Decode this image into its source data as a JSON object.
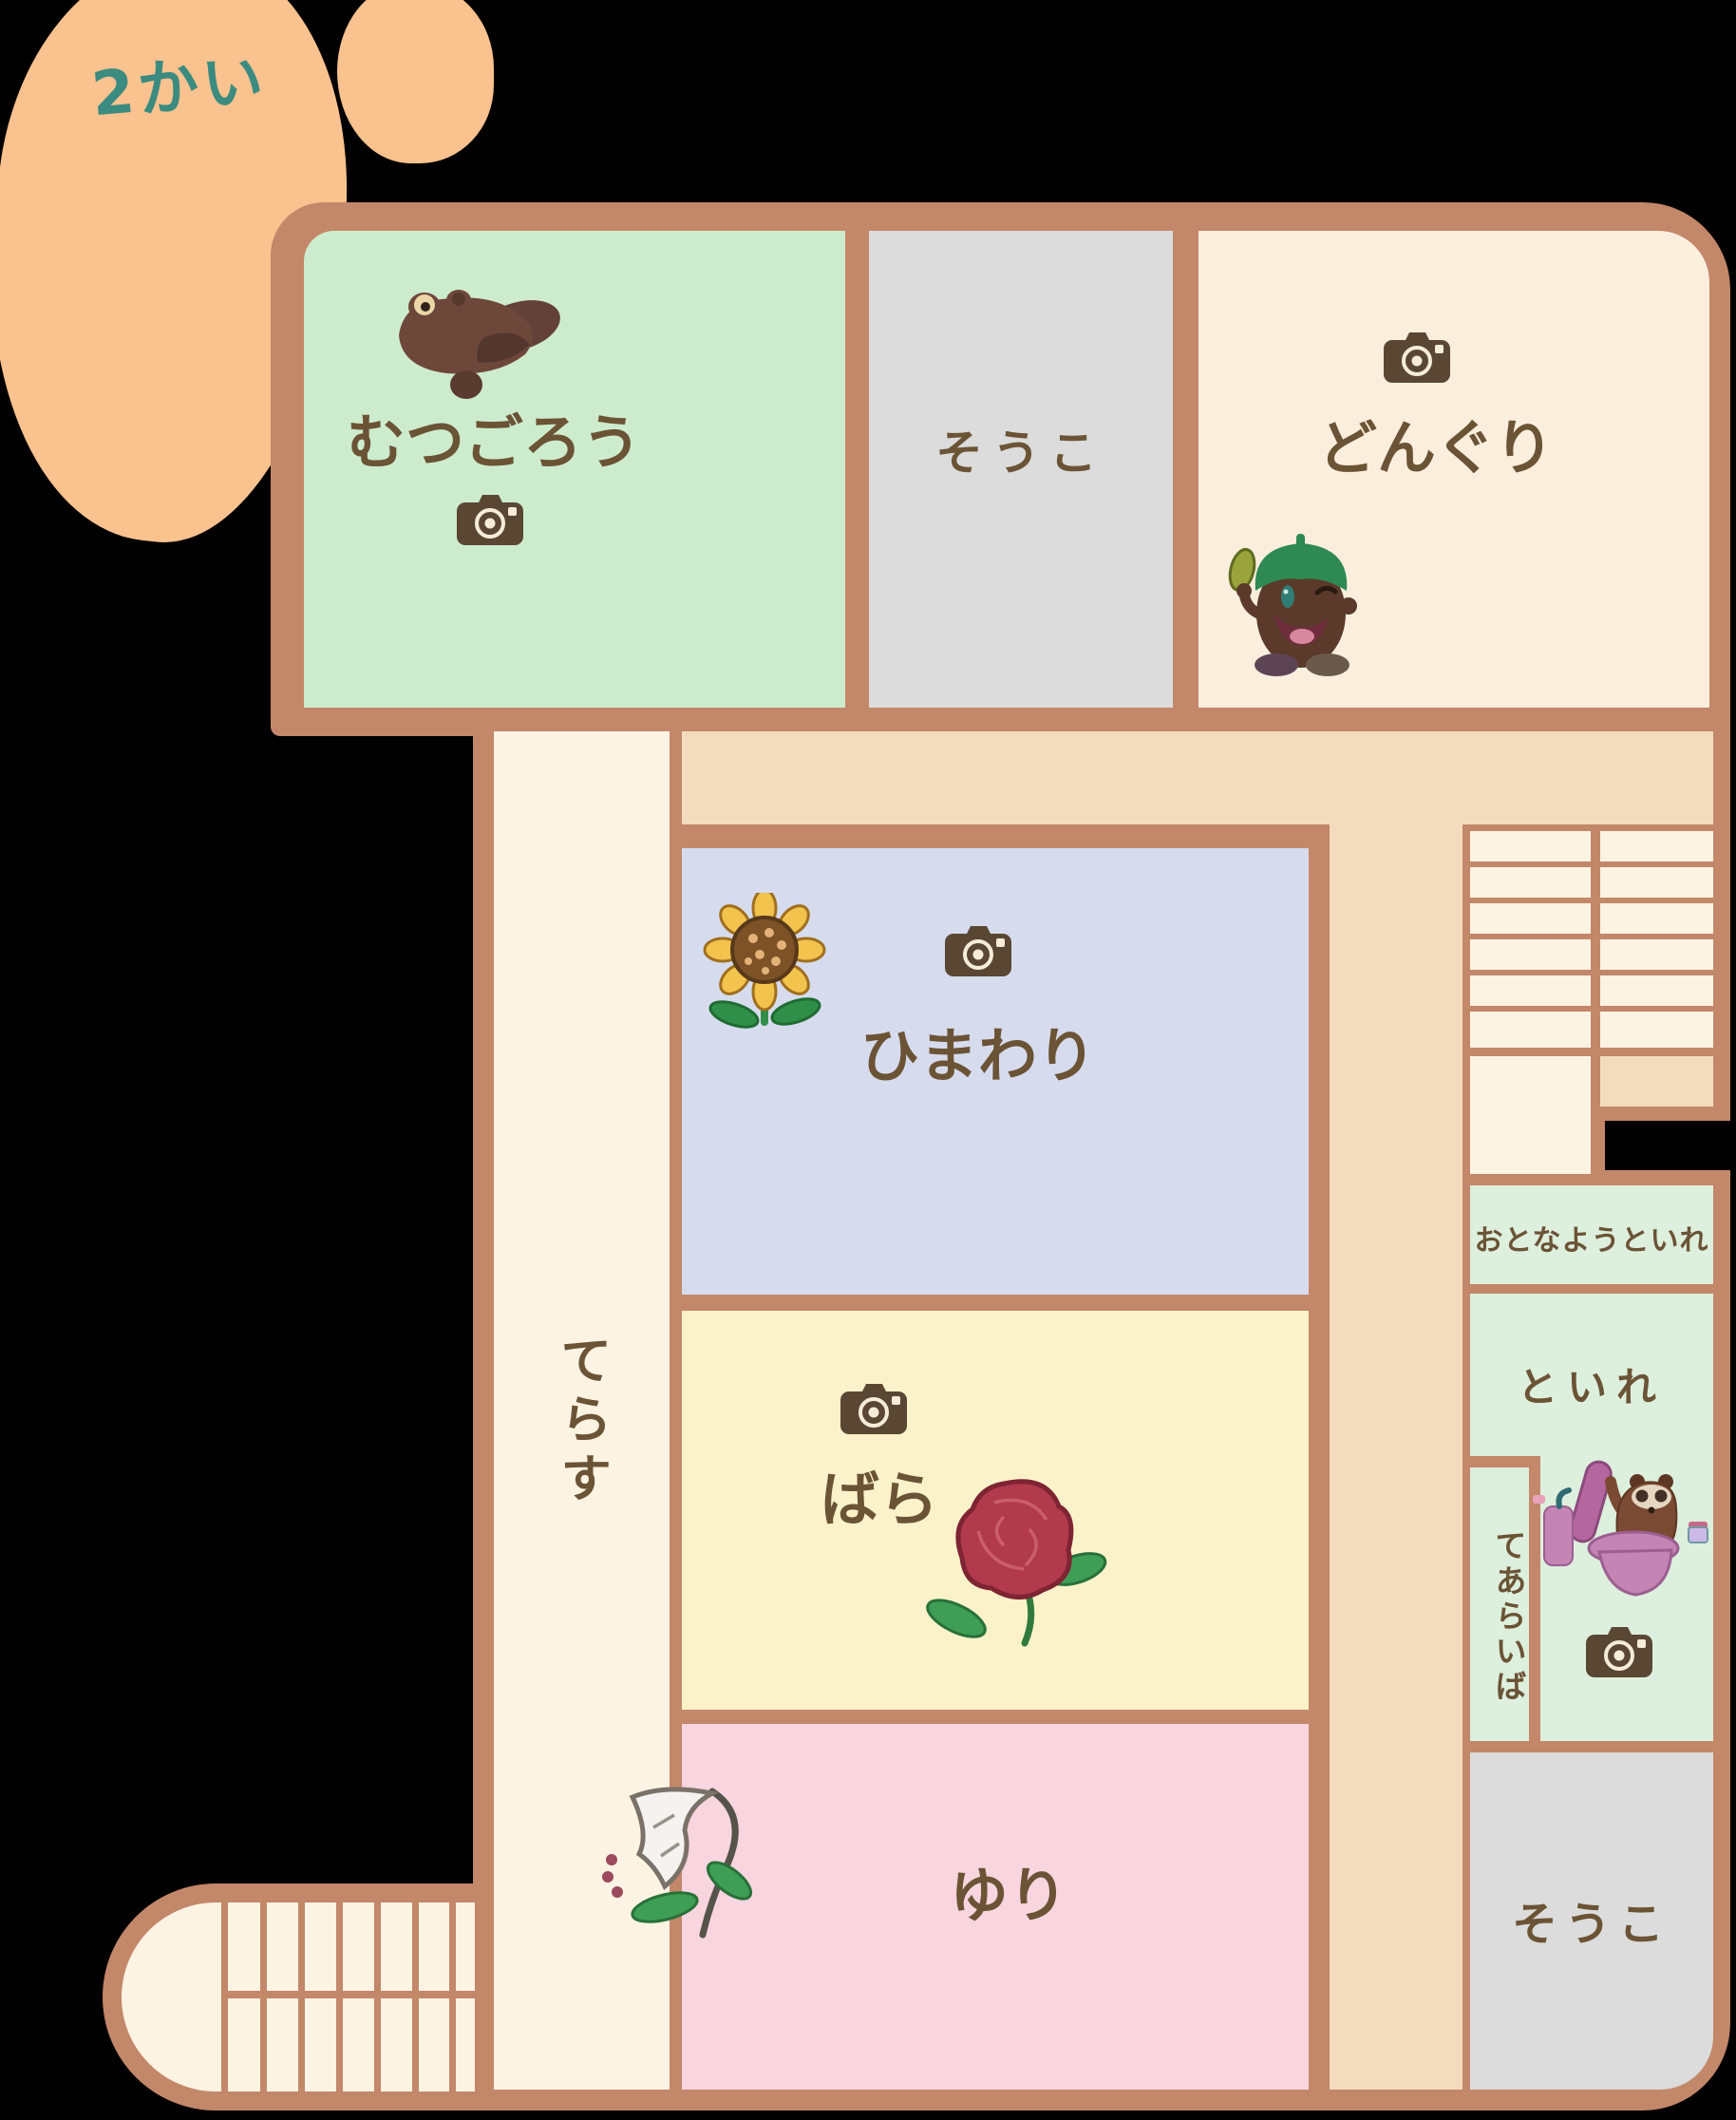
{
  "floor_label": "2かい",
  "building": {
    "rooms": {
      "mutsugorou": {
        "label": "むつごろう"
      },
      "souko_top": {
        "label": "そうこ"
      },
      "donguri": {
        "label": "どんぐり"
      },
      "himawari": {
        "label": "ひまわり"
      },
      "bara": {
        "label": "ばら"
      },
      "yuri": {
        "label": "ゆり"
      },
      "terasu": {
        "label": "てらす"
      },
      "otona_you_toire": {
        "label": "おとなようといれ"
      },
      "toire": {
        "label": "といれ"
      },
      "tearaiba": {
        "label": "てあらいば"
      },
      "souko_bottom": {
        "label": "そうこ"
      }
    },
    "icons": {
      "camera": "camera-icon",
      "mudskipper": "mudskipper-character",
      "acorn": "acorn-character",
      "sunflower": "sunflower-illustration",
      "rose": "rose-illustration",
      "lily": "lily-illustration",
      "tanuki_toilet": "tanuki-on-toilet-illustration"
    },
    "stairs": {
      "top_right_treads": 12,
      "bottom_left_treads": 14
    }
  },
  "colors": {
    "wall": "#c3876a",
    "room_green": "#cdeccd",
    "room_gray": "#dbdcdb",
    "room_cream": "#fceedd",
    "hallway_tan": "#f2dcbd",
    "corridor_cream": "#fdf3e3",
    "room_lavender": "#d6dcee",
    "room_yellow": "#fbf2ca",
    "room_pink": "#f9d5df",
    "room_toilet_green": "#ddefdd",
    "text_brown": "#6b5335",
    "floor_label_teal": "#3b8b80",
    "blob_orange": "#f9c28e",
    "camera_brown": "#5a4733"
  }
}
